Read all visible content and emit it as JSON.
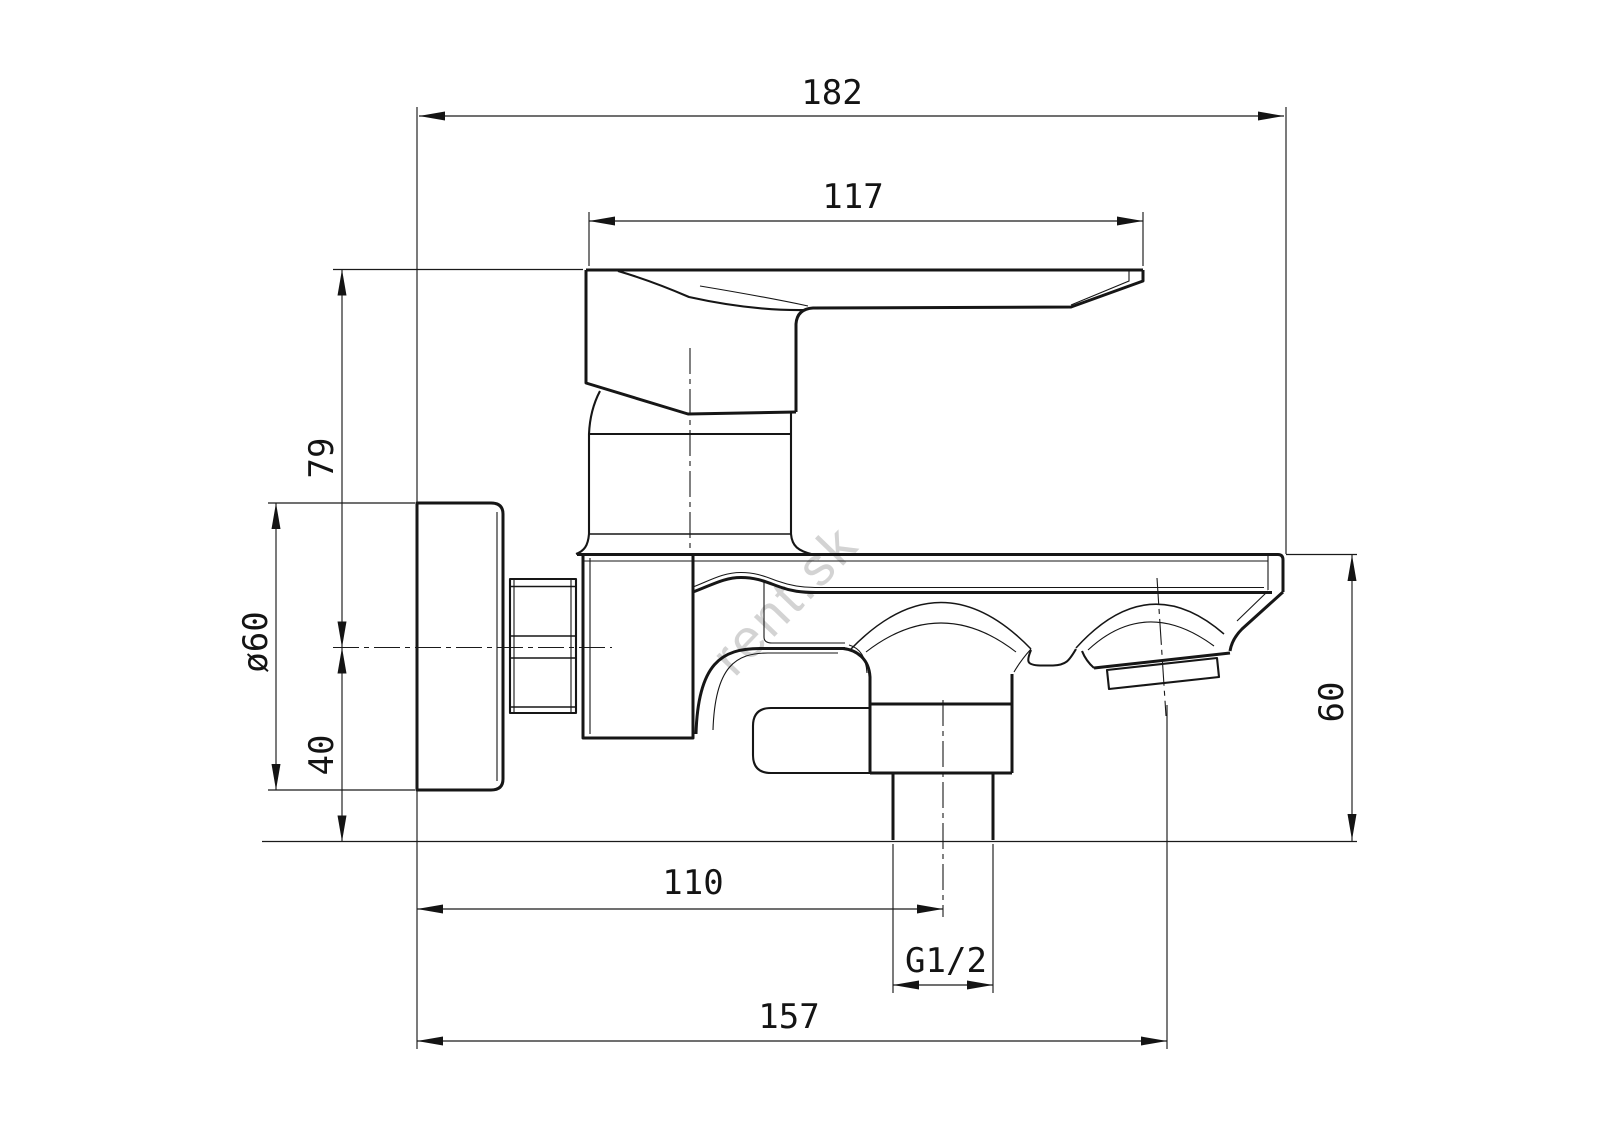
{
  "drawing": {
    "watermark": "rent.sk",
    "dimensions": {
      "overall_width": "182",
      "handle_length": "117",
      "handle_height": "79",
      "flange_diameter": "ø60",
      "center_to_bottom": "40",
      "spout_height": "60",
      "wall_to_shower_outlet": "110",
      "thread": "G1/2",
      "wall_to_spout_axis": "157"
    }
  }
}
